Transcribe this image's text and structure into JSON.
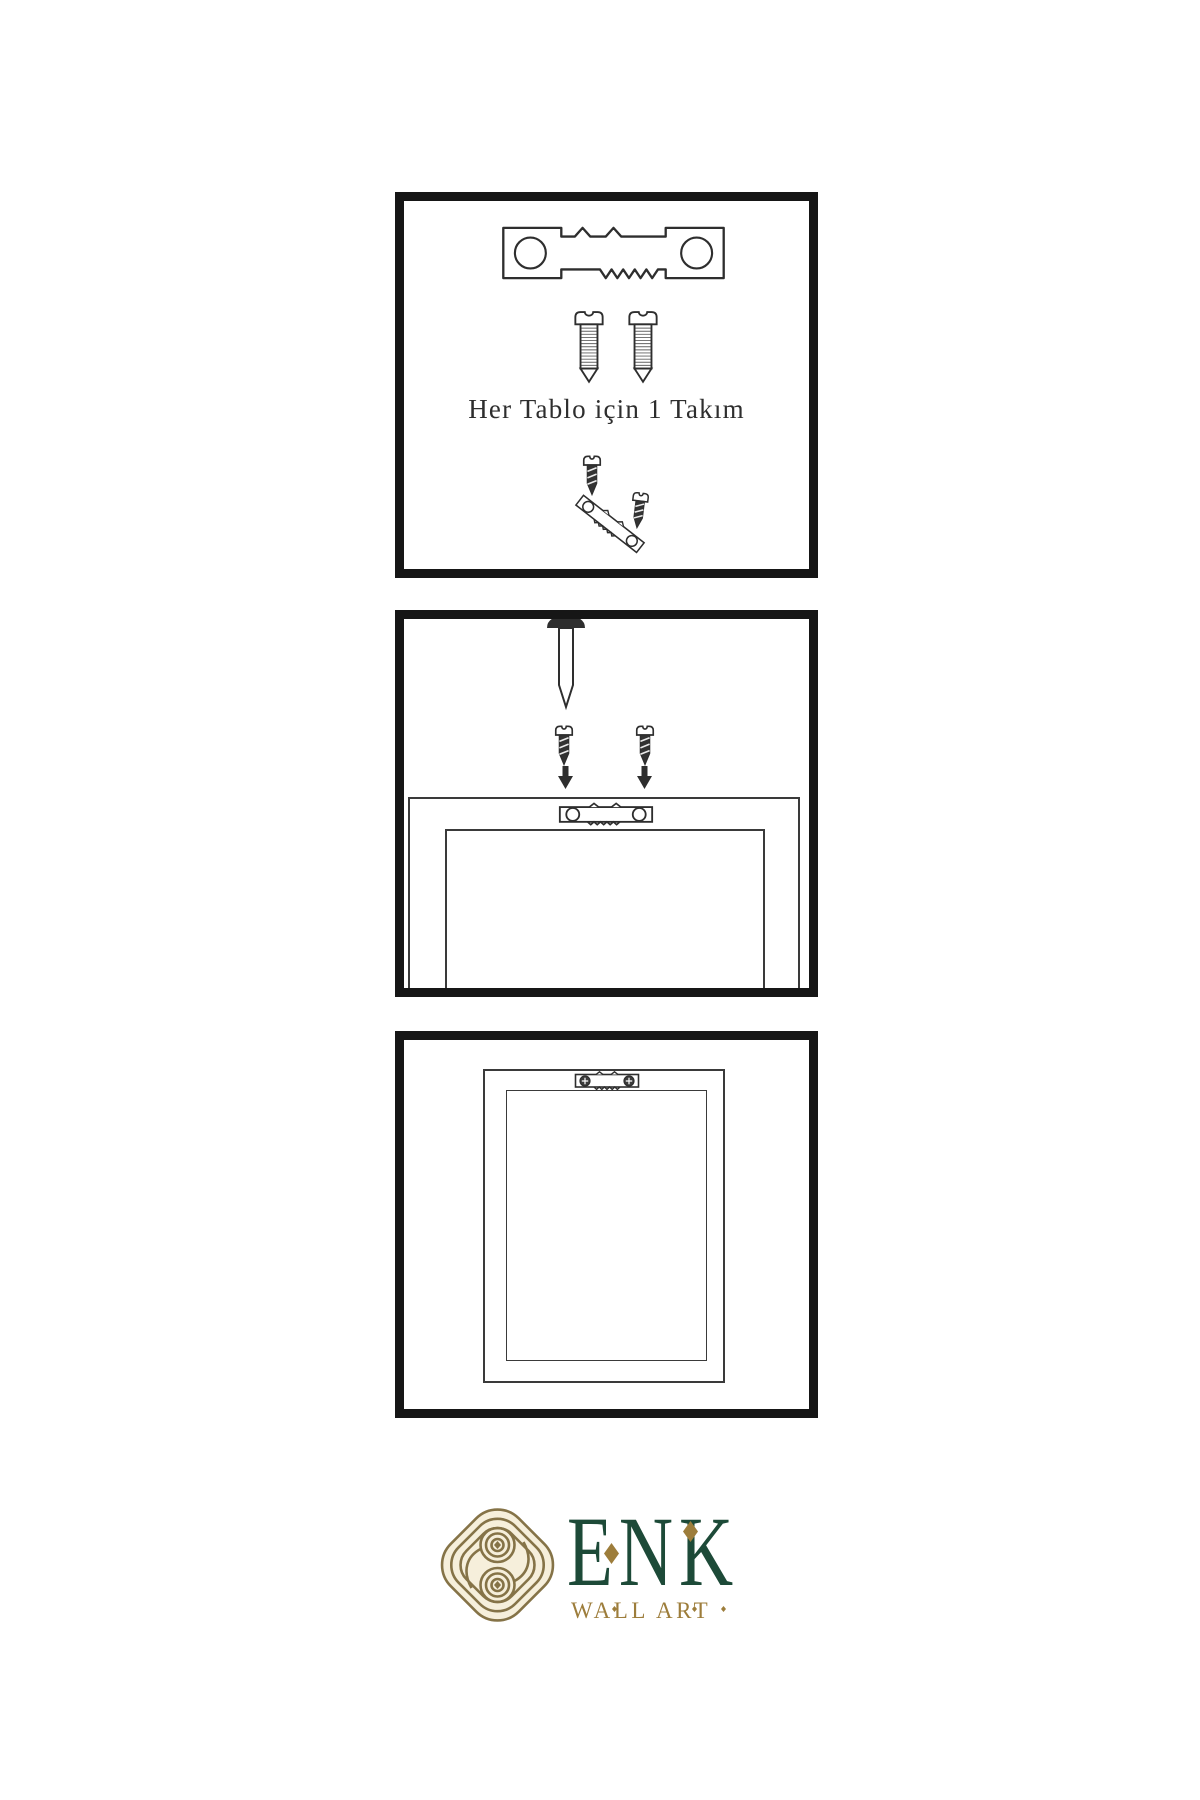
{
  "colors": {
    "background": "#ffffff",
    "ink": "#2e2e2e",
    "panel_border": "#161616",
    "frame_line": "#3a3a3a",
    "brand_green": "#1d4a38",
    "brand_gold": "#9d7d3b",
    "icon_gold": "#857347",
    "icon_fill": "#f6efdb"
  },
  "steps": [
    {
      "name": "hardware-kit",
      "caption": "Her Tablo için 1 Takım",
      "icons": [
        "sawtooth-hanger-icon",
        "screw-icon",
        "screw-icon",
        "dark-screw-icon",
        "angled-sawtooth-hanger-icon",
        "dark-screw-icon"
      ]
    },
    {
      "name": "nail-wall-and-screw-hanger",
      "icons": [
        "wall-nail-icon",
        "dark-screw-icon",
        "dark-screw-icon",
        "down-arrow-icon",
        "down-arrow-icon",
        "sawtooth-hanger-icon",
        "frame-back"
      ]
    },
    {
      "name": "mounted-frame",
      "icons": [
        "frame-back",
        "mounted-sawtooth-hanger-icon"
      ]
    }
  ],
  "logo": {
    "brand": "ENK",
    "tagline": "WALL ART"
  }
}
